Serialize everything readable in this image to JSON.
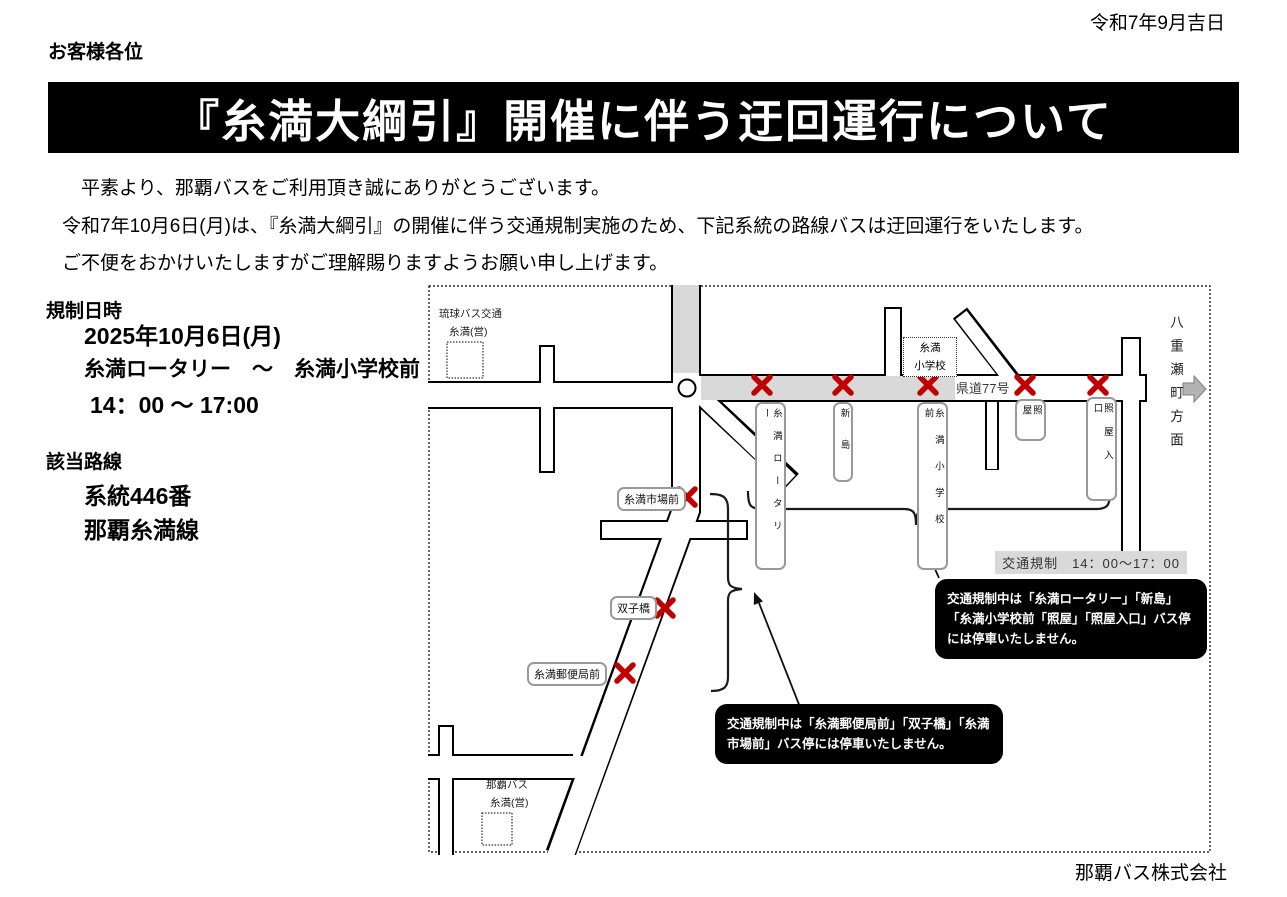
{
  "meta": {
    "date_line": "令和7年9月吉日",
    "salutation": "お客様各位",
    "company": "那覇バス株式会社"
  },
  "title": "『糸満大綱引』開催に伴う迂回運行について",
  "body": {
    "line1": "　平素より、那覇バスをご利用頂き誠にありがとうございます。",
    "line2": "令和7年10月6日(月)は、『糸満大綱引』の開催に伴う交通規制実施のため、下記系統の路線バスは迂回運行をいたします。",
    "line3": "ご不便をおかけいたしますがご理解賜りますようお願い申し上げます。"
  },
  "restriction": {
    "heading": "規制日時",
    "date": "2025年10月6日(月)",
    "section": "糸満ロータリー　～　糸満小学校前",
    "time": "14：00 ～ 17:00"
  },
  "routes": {
    "heading": "該当路線",
    "lines": [
      "系統446番",
      "那覇糸満線"
    ]
  },
  "map": {
    "depot_top": {
      "line1": "琉球バス交通",
      "line2": "糸満(営)"
    },
    "depot_bottom": {
      "line1": "那覇バス",
      "line2": "糸満(営)"
    },
    "school": {
      "line1": "糸満",
      "line2": "小学校"
    },
    "road_label": "県道77号",
    "direction_label": "八重瀬町方面",
    "regulation_label": "交通規制　14：00～17：00",
    "stops_vertical": [
      "糸満ロータリー",
      "新島",
      "糸満小学校前",
      "照屋",
      "照屋入口"
    ],
    "stops_horizontal": [
      "糸満市場前",
      "双子橋",
      "糸満郵便局前"
    ],
    "callout_main": "交通規制中は「糸満ロータリー」「新島」「糸満小学校前「照屋」「照屋入口」バス停には停車いたしません。",
    "callout_branch": "交通規制中は「糸満郵便局前」「双子橋」「糸満市場前」バス停には停車いたしません。",
    "colors": {
      "restricted_road": "#d9d9d9",
      "stop_closed_x": "#c00000",
      "callout_bg": "#000000"
    }
  }
}
